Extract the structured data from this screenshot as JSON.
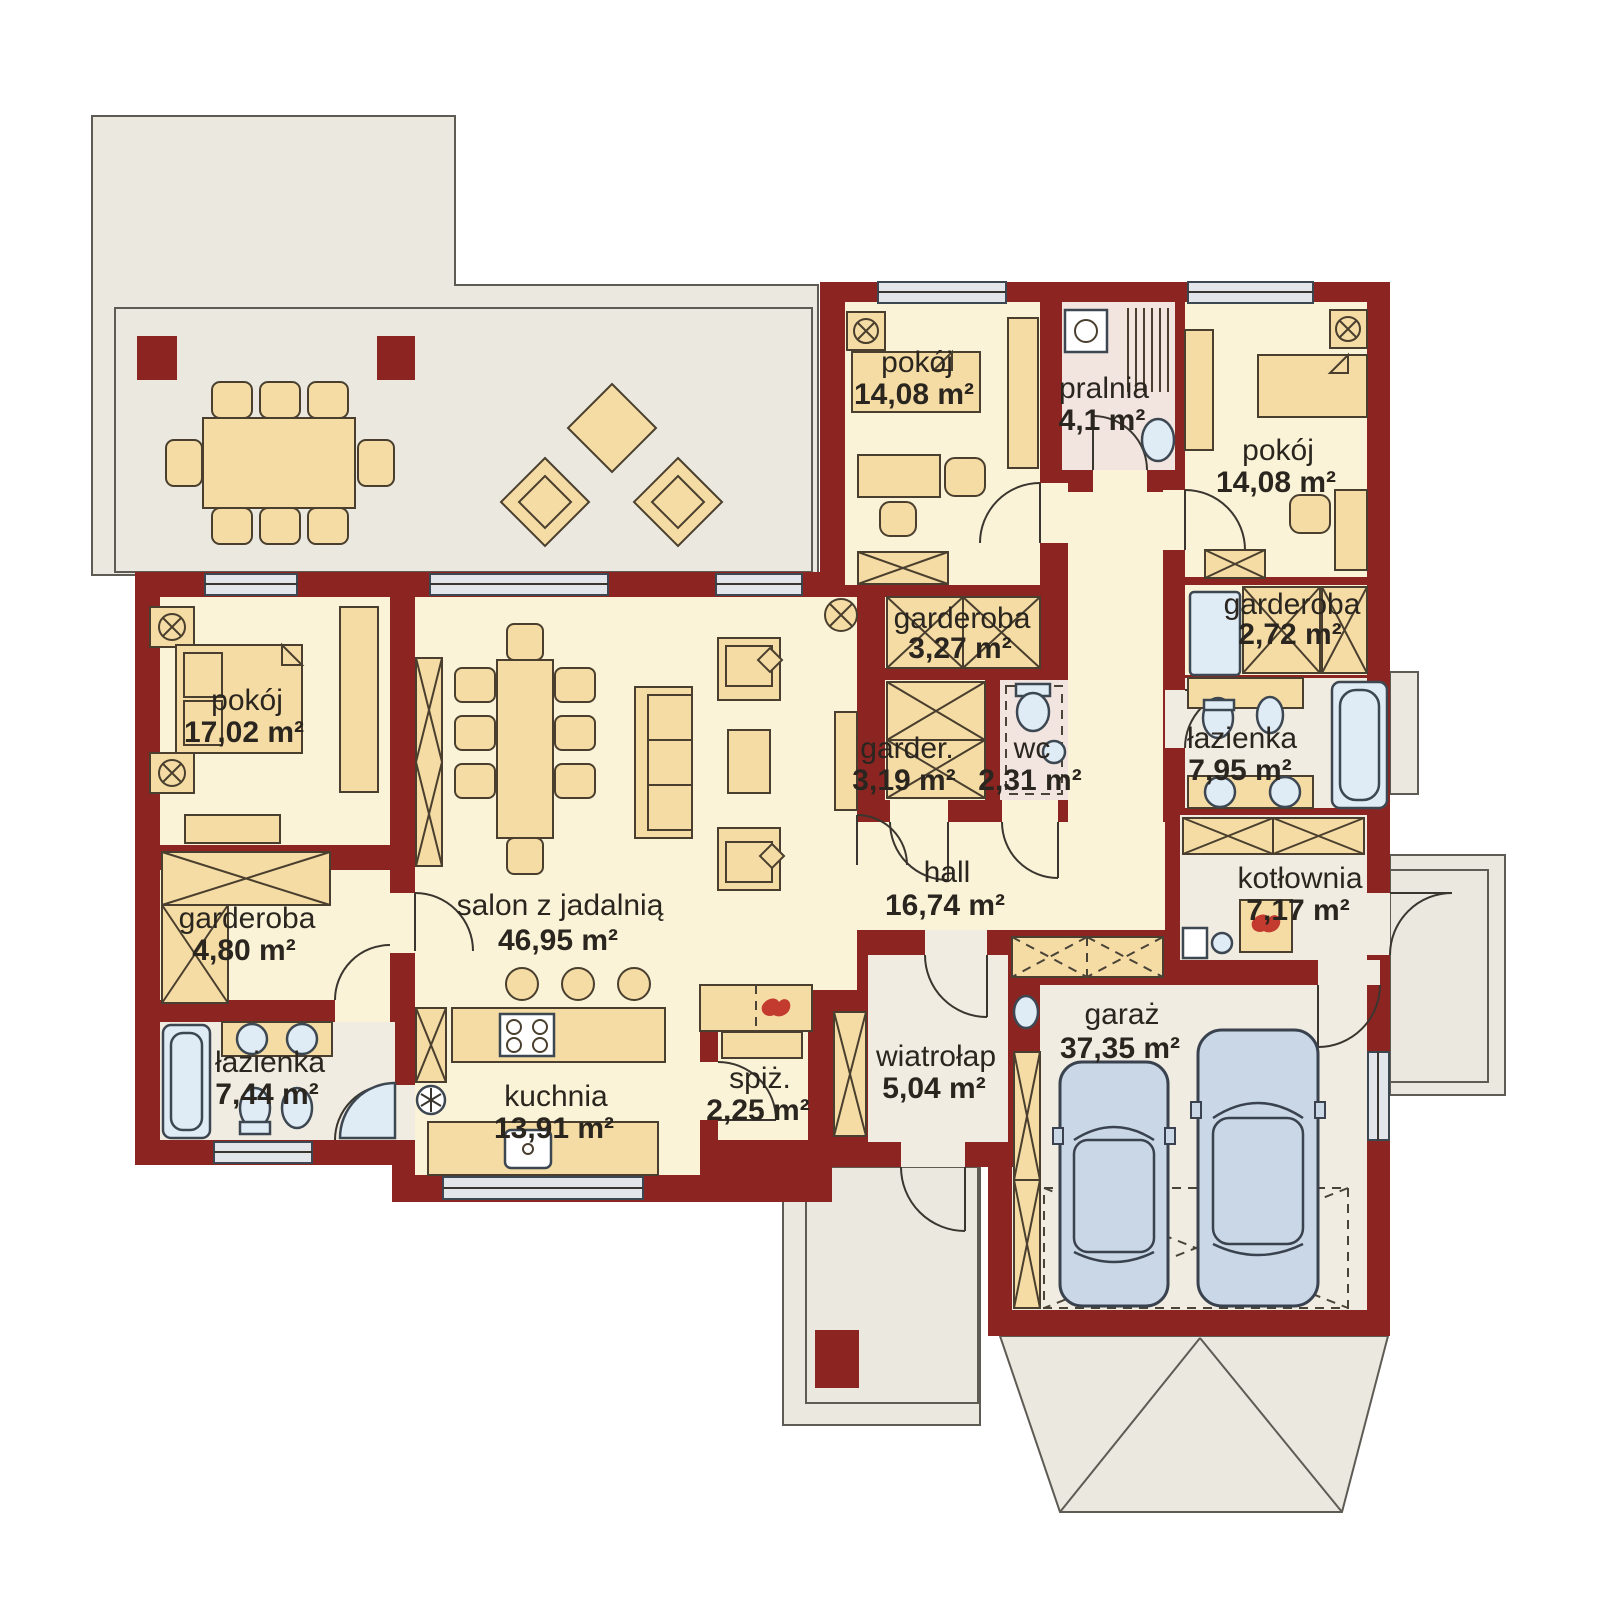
{
  "plan": {
    "title": "floor-plan",
    "colors": {
      "wall": "#8c2522",
      "floor": "#fbf3d7",
      "floor_gray": "#f0ece1",
      "floor_pink": "#f2e5e0",
      "terrace": "#ebe8df",
      "furniture": "#f5dca4",
      "fixture_blue": "#dfebf5",
      "car": "#c9d7e6",
      "flame": "#c23b2e",
      "text": "#2a261f"
    },
    "rooms": {
      "p1408a": {
        "name": "pokój",
        "area": "14,08 m²"
      },
      "pralnia": {
        "name": "pralnia",
        "area": "4,1 m²"
      },
      "p1408b": {
        "name": "pokój",
        "area": "14,08 m²"
      },
      "g327": {
        "name": "garderoba",
        "area": "3,27 m²"
      },
      "g272": {
        "name": "garderoba",
        "area": "2,72 m²"
      },
      "g319": {
        "name": "garder.",
        "area": "3,19 m²"
      },
      "wc": {
        "name": "wc",
        "area": "2,31 m²"
      },
      "laz795": {
        "name": "łazienka",
        "area": "7,95 m²"
      },
      "p1702": {
        "name": "pokój",
        "area": "17,02 m²"
      },
      "g480": {
        "name": "garderoba",
        "area": "4,80 m²"
      },
      "salon": {
        "name": "salon z jadalnią",
        "area": "46,95 m²"
      },
      "hall": {
        "name": "hall",
        "area": "16,74 m²"
      },
      "kotlownia": {
        "name": "kotłownia",
        "area": "7,17 m²"
      },
      "laz744": {
        "name": "łazienka",
        "area": "7,44 m²"
      },
      "kuchnia": {
        "name": "kuchnia",
        "area": "13,91 m²"
      },
      "spiz": {
        "name": "spiż.",
        "area": "2,25 m²"
      },
      "wiatrolap": {
        "name": "wiatrołap",
        "area": "5,04 m²"
      },
      "garaz": {
        "name": "garaż",
        "area": "37,35 m²"
      }
    }
  }
}
